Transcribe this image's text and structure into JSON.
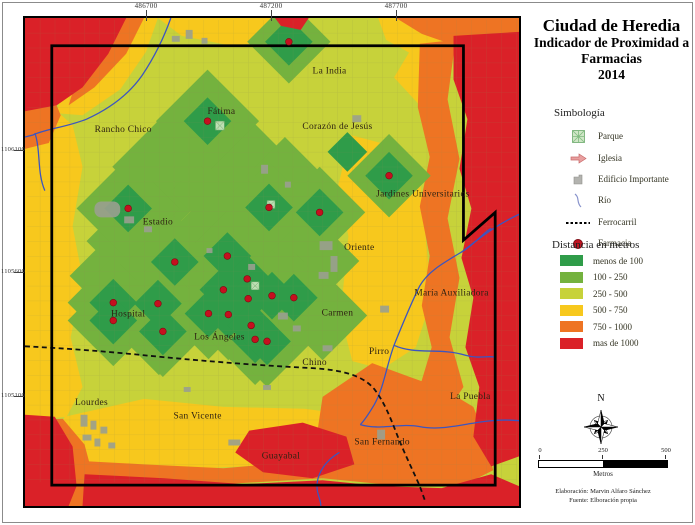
{
  "title": {
    "line1": "Ciudad de Heredia",
    "line2": "Indicador de Proximidad a",
    "line3": "Farmacias",
    "line4": "2014"
  },
  "legend": {
    "symbology_heading": "Simbología",
    "symbols": [
      {
        "label": "Parque",
        "icon": "park-icon"
      },
      {
        "label": "Iglesia",
        "icon": "church-icon"
      },
      {
        "label": "Edificio Importante",
        "icon": "building-icon"
      },
      {
        "label": "Río",
        "icon": "river-icon"
      },
      {
        "label": "Ferrocarril",
        "icon": "railroad-icon"
      },
      {
        "label": "Farmacia",
        "icon": "pharmacy-icon"
      }
    ],
    "distance_heading": "Distancia en metros",
    "distance_classes": [
      {
        "label": "menos de 100",
        "color": "#2f9c49"
      },
      {
        "label": "100 - 250",
        "color": "#74b23e"
      },
      {
        "label": "250 - 500",
        "color": "#c7d23a"
      },
      {
        "label": "500 - 750",
        "color": "#f7c81d"
      },
      {
        "label": "750 - 1000",
        "color": "#ee7423"
      },
      {
        "label": "mas de 1000",
        "color": "#da2128"
      }
    ]
  },
  "map": {
    "coordinates": {
      "top": [
        "486700",
        "487200",
        "487700"
      ],
      "left": [
        "1106100",
        "1105600",
        "1105100"
      ]
    },
    "place_labels": [
      {
        "text": "La India",
        "x": 307,
        "y": 56
      },
      {
        "text": "Fátima",
        "x": 198,
        "y": 97
      },
      {
        "text": "Rancho Chico",
        "x": 99,
        "y": 115
      },
      {
        "text": "Corazón de Jesús",
        "x": 315,
        "y": 112
      },
      {
        "text": "Jardines Universitarios",
        "x": 401,
        "y": 180
      },
      {
        "text": "Estadio",
        "x": 134,
        "y": 208
      },
      {
        "text": "Oriente",
        "x": 337,
        "y": 234
      },
      {
        "text": "María Auxiliadora",
        "x": 430,
        "y": 280
      },
      {
        "text": "Hospital",
        "x": 104,
        "y": 301
      },
      {
        "text": "Carmen",
        "x": 315,
        "y": 300
      },
      {
        "text": "Los Ángeles",
        "x": 196,
        "y": 324
      },
      {
        "text": "Chino",
        "x": 292,
        "y": 350
      },
      {
        "text": "Pirro",
        "x": 357,
        "y": 339
      },
      {
        "text": "Lourdes",
        "x": 67,
        "y": 390
      },
      {
        "text": "San Vicente",
        "x": 174,
        "y": 404
      },
      {
        "text": "La Puebla",
        "x": 449,
        "y": 384
      },
      {
        "text": "San Fernando",
        "x": 360,
        "y": 430
      },
      {
        "text": "Guayabal",
        "x": 258,
        "y": 444
      }
    ],
    "farmacias": [
      {
        "x": 266,
        "y": 24,
        "mid": 42
      },
      {
        "x": 184,
        "y": 104,
        "mid": 52
      },
      {
        "x": 104,
        "y": 192,
        "mid": 52
      },
      {
        "x": 246,
        "y": 191
      },
      {
        "x": 297,
        "y": 196
      },
      {
        "x": 367,
        "y": 159,
        "mid": 42
      },
      {
        "x": 151,
        "y": 246
      },
      {
        "x": 204,
        "y": 240
      },
      {
        "x": 224,
        "y": 263
      },
      {
        "x": 200,
        "y": 274
      },
      {
        "x": 225,
        "y": 283
      },
      {
        "x": 249,
        "y": 280
      },
      {
        "x": 271,
        "y": 282
      },
      {
        "x": 89,
        "y": 287
      },
      {
        "x": 134,
        "y": 288
      },
      {
        "x": 89,
        "y": 305
      },
      {
        "x": 185,
        "y": 298
      },
      {
        "x": 205,
        "y": 299
      },
      {
        "x": 228,
        "y": 310
      },
      {
        "x": 139,
        "y": 316
      },
      {
        "x": 232,
        "y": 324
      },
      {
        "x": 244,
        "y": 326
      }
    ]
  },
  "compass": {
    "north_label": "N"
  },
  "scale_bar": {
    "ticks": [
      "0",
      "250",
      "500"
    ],
    "unit": "Metros"
  },
  "credits": {
    "line1": "Elaboración: Marvin Alfaro Sánchez",
    "line2": "Fuente: Elboración propia"
  }
}
